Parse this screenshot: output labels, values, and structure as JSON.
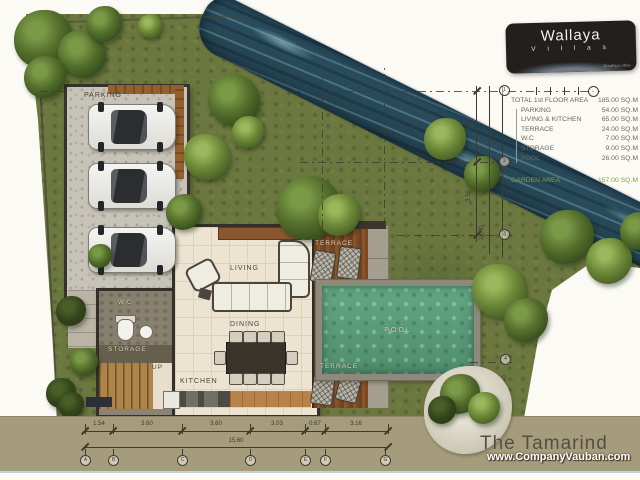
{
  "logo": {
    "brand": "Wallaya",
    "sub": "V i l l a s",
    "handle": "@wallaya.villas"
  },
  "area_table": {
    "title_label": "TOTAL 1st FLOOR AREA",
    "title_value": "185.00 SQ.M",
    "rows": [
      {
        "label": "PARKING",
        "value": "54.00 SQ.M"
      },
      {
        "label": "LIVING & KITCHEN",
        "value": "65.00 SQ.M"
      },
      {
        "label": "TERRACE",
        "value": "24.00 SQ.M"
      },
      {
        "label": "W.C",
        "value": "7.00 SQ.M"
      },
      {
        "label": "STORAGE",
        "value": "9.00 SQ.M"
      },
      {
        "label": "POOL",
        "value": "26.00 SQ.M"
      }
    ],
    "garden_label": "GARDEN AREA",
    "garden_value": "157.00 SQ.M"
  },
  "plan_labels": {
    "parking": "PARKING",
    "wc": "W.C",
    "storage": "STORAGE",
    "up": "UP",
    "living": "LIVING",
    "dining": "DINING",
    "kitchen": "KITCHEN",
    "terrace_top": "TERRACE",
    "terrace_bottom": "TERRACE",
    "pool": "POOL"
  },
  "dimensions": {
    "bottom_segments": [
      "1.54",
      "3.60",
      "3.60",
      "3.03",
      "0.67",
      "3.16"
    ],
    "bottom_total": "15.60",
    "right_segments": [
      "3.50",
      "3.50"
    ],
    "right_lower": "3.40",
    "right_total": "10.40",
    "bubbles_bottom": [
      "A",
      "B",
      "C",
      "D",
      "E",
      "F",
      "G"
    ],
    "bubbles_right": [
      "1",
      "2",
      "3",
      "4"
    ]
  },
  "footer": {
    "title": "The Tamarind",
    "watermark": "www.CompanyVauban.com"
  },
  "colors": {
    "grass": "#6d7840",
    "water": "#2c5062",
    "pool": "#5d9f82",
    "strip": "#a59c7d",
    "garden_text": "#7ca23b"
  }
}
